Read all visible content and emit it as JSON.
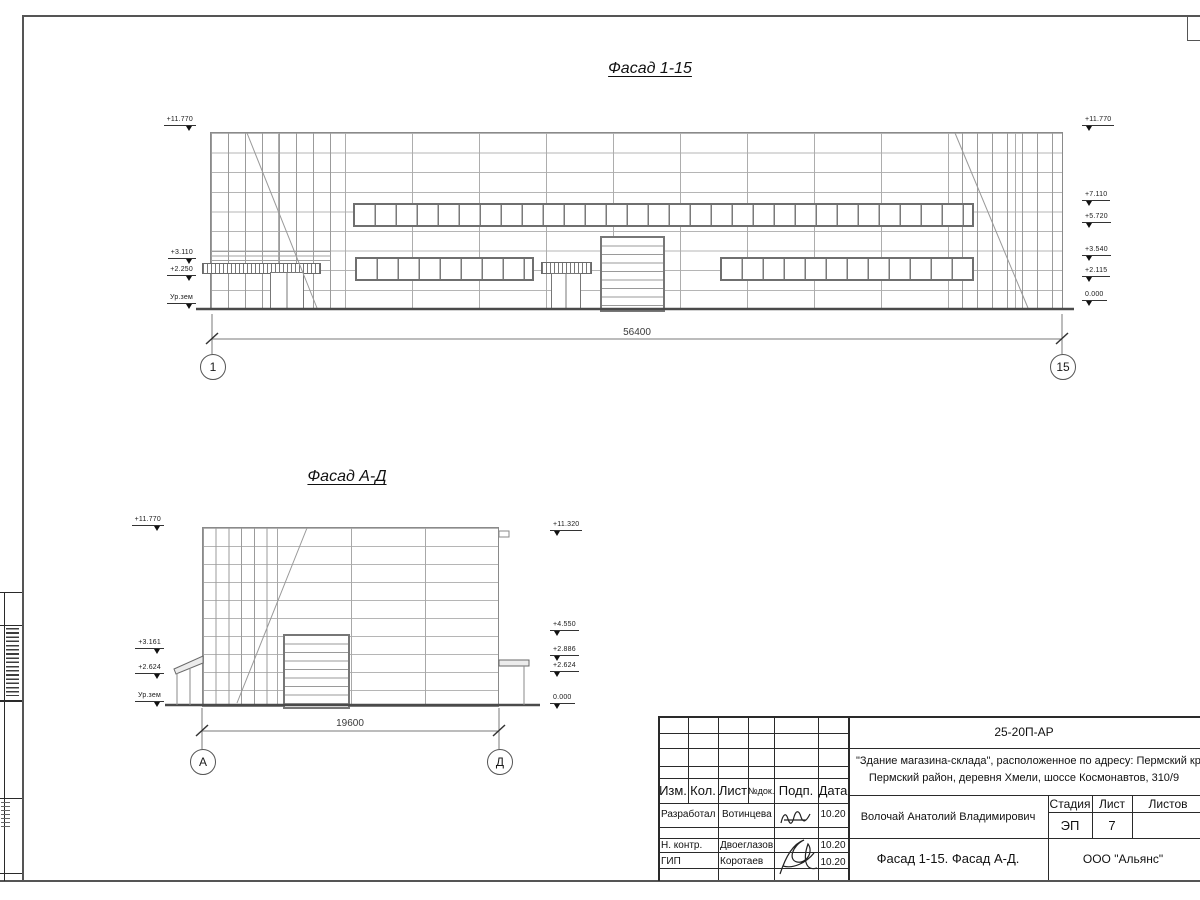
{
  "facade1": {
    "title": "Фасад 1-15",
    "dimension": "56400",
    "axis_left": "1",
    "axis_right": "15",
    "elev": {
      "l0": "+11.770",
      "l1": "+3.110",
      "l2": "+2.250",
      "l3": "Ур.зем",
      "r0": "+11.770",
      "r1": "+7.110",
      "r2": "+5.720",
      "r3": "+3.540",
      "r4": "+2.115",
      "r5": "0.000"
    }
  },
  "facade2": {
    "title": "Фасад А-Д",
    "dimension": "19600",
    "axis_left": "А",
    "axis_right": "Д",
    "elev": {
      "l0": "+11.770",
      "l1": "+3.161",
      "l2": "+2.624",
      "l3": "Ур.зем",
      "r0": "+11.320",
      "r1": "+4.550",
      "r2": "+2.886",
      "r3": "+2.624",
      "r4": "0.000"
    }
  },
  "title_block": {
    "doc_number": "25-20П-АР",
    "description_line1": "\"Здание магазина-склада\", расположенное по адресу: Пермский край,",
    "description_line2": "Пермский район, деревня Хмели, шоссе Космонавтов, 310/9",
    "cols": {
      "c0": "Изм.",
      "c1": "Кол.",
      "c2": "Лист",
      "c3": "№док.",
      "c4": "Подп.",
      "c5": "Дата"
    },
    "rows": [
      {
        "role": "Разработал",
        "name": "Вотинцева",
        "date": "10.20"
      },
      {
        "role": "Н. контр.",
        "name": "Двоеглазов",
        "date": "10.20"
      },
      {
        "role": "ГИП",
        "name": "Коротаев",
        "date": "10.20"
      }
    ],
    "author": "Волочай Анатолий Владимирович",
    "stage_label": "Стадия",
    "sheet_label": "Лист",
    "sheets_label": "Листов",
    "stage_value": "ЭП",
    "sheet_value": "7",
    "drawing_title": "Фасад 1-15. Фасад А-Д.",
    "company": "ООО \"Альянс\""
  }
}
